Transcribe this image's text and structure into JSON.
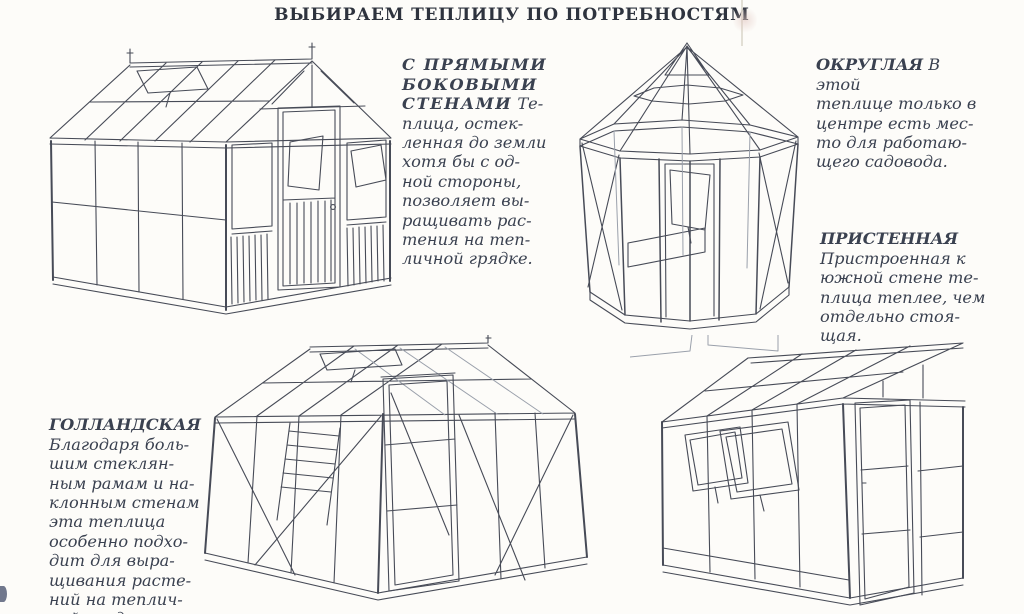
{
  "page": {
    "title": "ВЫБИРАЕМ ТЕПЛИЦУ ПО ПОТРЕБНОСТЯМ"
  },
  "colors": {
    "paper": "#fdfcf9",
    "ink": "#3a4150",
    "line": "#474b57"
  },
  "sections": {
    "straight": {
      "heading": "С ПРЯМЫМИ\nБОКОВЫМИ\nСТЕНАМИ",
      "body": " Те-\nплица, остек-\nленная до земли\nхотя бы с од-\nной стороны,\nпозволяет вы-\nращивать рас-\nтения на теп-\nличной грядке.",
      "illustration": "gable-greenhouse-with-straight-side-walls"
    },
    "round": {
      "heading": "ОКРУГЛАЯ",
      "body": " В этой\nтеплице только в\nцентре есть мес-\nто для работаю-\nщего садовода.",
      "illustration": "octagonal-round-greenhouse"
    },
    "wall": {
      "heading": "ПРИСТЕННАЯ",
      "body": "\nПристроенная к\nюжной стене те-\nплица теплее, чем\nотдельно стоя-\nщая.",
      "illustration": "lean-to-wall-greenhouse"
    },
    "dutch": {
      "heading": "ГОЛЛАНДСКАЯ",
      "body": "\nБлагодаря боль-\nшим стеклян-\nным рамам и на-\nклонным стенам\nэта теплица\nособенно подхо-\nдит для выра-\nщивания расте-\nний на теплич-\nной грядке.",
      "illustration": "dutch-greenhouse-with-sloped-walls"
    }
  }
}
